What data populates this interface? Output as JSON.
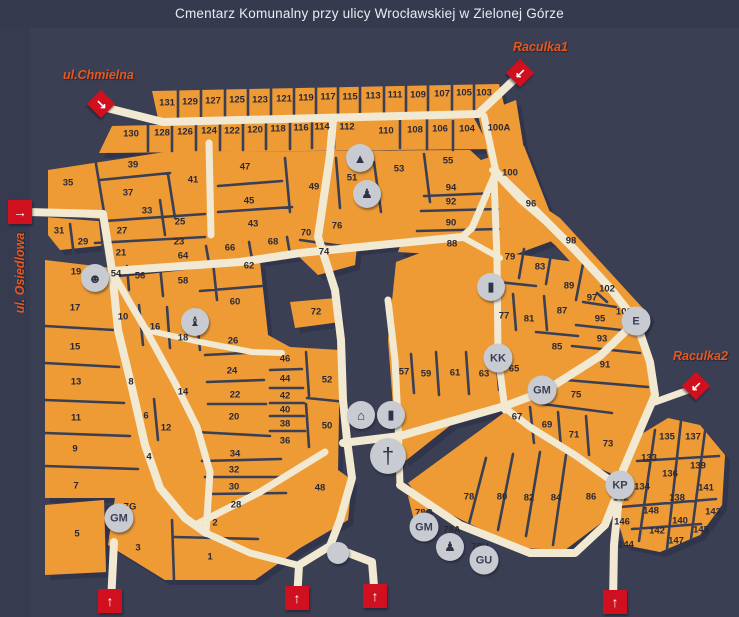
{
  "title": "Cmentarz Komunalny przy ulicy Wrocławskiej w Zielonej Górze",
  "streets": {
    "chmielna": "ul.Chmielna",
    "raculka1": "Raculka1",
    "raculka2": "Raculka2",
    "osiedlowa": "ul. Osiedlowa"
  },
  "colors": {
    "background": "#3b3f54",
    "block_orange": "#ef9b36",
    "path_cream": "#f2e9d2",
    "marker_red": "#d0101e",
    "street_label": "#e8571c",
    "badge_gray": "#c8cbd1",
    "title_text": "#e9ebf3",
    "number_text": "#2b2833"
  },
  "map": {
    "sections": [
      {
        "n": "131",
        "x": 167,
        "y": 103
      },
      {
        "n": "129",
        "x": 190,
        "y": 102
      },
      {
        "n": "127",
        "x": 213,
        "y": 101
      },
      {
        "n": "125",
        "x": 237,
        "y": 100
      },
      {
        "n": "123",
        "x": 260,
        "y": 100
      },
      {
        "n": "121",
        "x": 284,
        "y": 99
      },
      {
        "n": "119",
        "x": 306,
        "y": 98
      },
      {
        "n": "117",
        "x": 328,
        "y": 97
      },
      {
        "n": "115",
        "x": 350,
        "y": 97
      },
      {
        "n": "113",
        "x": 373,
        "y": 96
      },
      {
        "n": "111",
        "x": 395,
        "y": 95
      },
      {
        "n": "109",
        "x": 418,
        "y": 95
      },
      {
        "n": "107",
        "x": 442,
        "y": 94
      },
      {
        "n": "105",
        "x": 464,
        "y": 93
      },
      {
        "n": "103",
        "x": 484,
        "y": 93
      },
      {
        "n": "130",
        "x": 131,
        "y": 134
      },
      {
        "n": "128",
        "x": 162,
        "y": 133
      },
      {
        "n": "126",
        "x": 185,
        "y": 132
      },
      {
        "n": "124",
        "x": 209,
        "y": 131
      },
      {
        "n": "122",
        "x": 232,
        "y": 131
      },
      {
        "n": "120",
        "x": 255,
        "y": 130
      },
      {
        "n": "118",
        "x": 278,
        "y": 129
      },
      {
        "n": "116",
        "x": 301,
        "y": 128
      },
      {
        "n": "114",
        "x": 322,
        "y": 127
      },
      {
        "n": "112",
        "x": 347,
        "y": 127
      },
      {
        "n": "110",
        "x": 386,
        "y": 131
      },
      {
        "n": "108",
        "x": 415,
        "y": 130
      },
      {
        "n": "106",
        "x": 440,
        "y": 129
      },
      {
        "n": "104",
        "x": 467,
        "y": 129
      },
      {
        "n": "100A",
        "x": 499,
        "y": 128
      },
      {
        "n": "35",
        "x": 68,
        "y": 183
      },
      {
        "n": "39",
        "x": 133,
        "y": 165
      },
      {
        "n": "37",
        "x": 128,
        "y": 193
      },
      {
        "n": "41",
        "x": 193,
        "y": 180
      },
      {
        "n": "47",
        "x": 245,
        "y": 167
      },
      {
        "n": "45",
        "x": 249,
        "y": 201
      },
      {
        "n": "49",
        "x": 314,
        "y": 187
      },
      {
        "n": "51",
        "x": 352,
        "y": 178
      },
      {
        "n": "53",
        "x": 399,
        "y": 169
      },
      {
        "n": "55",
        "x": 448,
        "y": 161
      },
      {
        "n": "33",
        "x": 147,
        "y": 211
      },
      {
        "n": "25",
        "x": 180,
        "y": 222
      },
      {
        "n": "43",
        "x": 253,
        "y": 224
      },
      {
        "n": "31",
        "x": 59,
        "y": 231
      },
      {
        "n": "27",
        "x": 122,
        "y": 231
      },
      {
        "n": "29",
        "x": 83,
        "y": 242
      },
      {
        "n": "23",
        "x": 179,
        "y": 242
      },
      {
        "n": "21",
        "x": 121,
        "y": 253
      },
      {
        "n": "76",
        "x": 337,
        "y": 226
      },
      {
        "n": "70",
        "x": 306,
        "y": 233
      },
      {
        "n": "68",
        "x": 273,
        "y": 242
      },
      {
        "n": "66",
        "x": 230,
        "y": 248
      },
      {
        "n": "64",
        "x": 183,
        "y": 256
      },
      {
        "n": "74",
        "x": 324,
        "y": 252
      },
      {
        "n": "19",
        "x": 76,
        "y": 272
      },
      {
        "n": "54",
        "x": 116,
        "y": 274
      },
      {
        "n": "56",
        "x": 140,
        "y": 276
      },
      {
        "n": "58",
        "x": 183,
        "y": 281
      },
      {
        "n": "62",
        "x": 249,
        "y": 266
      },
      {
        "n": "60",
        "x": 235,
        "y": 302
      },
      {
        "n": "72",
        "x": 316,
        "y": 312
      },
      {
        "n": "17",
        "x": 75,
        "y": 308
      },
      {
        "n": "10",
        "x": 123,
        "y": 317
      },
      {
        "n": "16",
        "x": 155,
        "y": 327
      },
      {
        "n": "18",
        "x": 183,
        "y": 338
      },
      {
        "n": "15",
        "x": 75,
        "y": 347
      },
      {
        "n": "26",
        "x": 233,
        "y": 341
      },
      {
        "n": "13",
        "x": 76,
        "y": 382
      },
      {
        "n": "8",
        "x": 131,
        "y": 382
      },
      {
        "n": "14",
        "x": 183,
        "y": 392
      },
      {
        "n": "24",
        "x": 232,
        "y": 371
      },
      {
        "n": "22",
        "x": 235,
        "y": 395
      },
      {
        "n": "20",
        "x": 234,
        "y": 417
      },
      {
        "n": "11",
        "x": 76,
        "y": 418
      },
      {
        "n": "6",
        "x": 146,
        "y": 416
      },
      {
        "n": "12",
        "x": 166,
        "y": 428
      },
      {
        "n": "9",
        "x": 75,
        "y": 449
      },
      {
        "n": "4",
        "x": 149,
        "y": 457
      },
      {
        "n": "34",
        "x": 235,
        "y": 454
      },
      {
        "n": "32",
        "x": 234,
        "y": 470
      },
      {
        "n": "30",
        "x": 234,
        "y": 487
      },
      {
        "n": "28",
        "x": 236,
        "y": 505
      },
      {
        "n": "7",
        "x": 76,
        "y": 486
      },
      {
        "n": "5",
        "x": 77,
        "y": 534
      },
      {
        "n": "3",
        "x": 138,
        "y": 548
      },
      {
        "n": "1",
        "x": 210,
        "y": 557
      },
      {
        "n": "2",
        "x": 215,
        "y": 523
      },
      {
        "n": "7G",
        "x": 130,
        "y": 507
      },
      {
        "n": "46",
        "x": 285,
        "y": 359
      },
      {
        "n": "44",
        "x": 285,
        "y": 379
      },
      {
        "n": "42",
        "x": 285,
        "y": 396
      },
      {
        "n": "40",
        "x": 285,
        "y": 410
      },
      {
        "n": "38",
        "x": 285,
        "y": 424
      },
      {
        "n": "36",
        "x": 285,
        "y": 441
      },
      {
        "n": "52",
        "x": 327,
        "y": 380
      },
      {
        "n": "50",
        "x": 327,
        "y": 426
      },
      {
        "n": "48",
        "x": 320,
        "y": 488
      },
      {
        "n": "57",
        "x": 404,
        "y": 372
      },
      {
        "n": "59",
        "x": 426,
        "y": 374
      },
      {
        "n": "61",
        "x": 455,
        "y": 373
      },
      {
        "n": "63",
        "x": 484,
        "y": 374
      },
      {
        "n": "65",
        "x": 514,
        "y": 369
      },
      {
        "n": "67",
        "x": 517,
        "y": 417
      },
      {
        "n": "69",
        "x": 547,
        "y": 425
      },
      {
        "n": "71",
        "x": 574,
        "y": 435
      },
      {
        "n": "73",
        "x": 608,
        "y": 444
      },
      {
        "n": "75",
        "x": 576,
        "y": 395
      },
      {
        "n": "100",
        "x": 510,
        "y": 173
      },
      {
        "n": "94",
        "x": 451,
        "y": 188
      },
      {
        "n": "92",
        "x": 451,
        "y": 202
      },
      {
        "n": "96",
        "x": 531,
        "y": 204
      },
      {
        "n": "90",
        "x": 451,
        "y": 223
      },
      {
        "n": "88",
        "x": 452,
        "y": 244
      },
      {
        "n": "98",
        "x": 571,
        "y": 241
      },
      {
        "n": "79",
        "x": 510,
        "y": 257
      },
      {
        "n": "83",
        "x": 540,
        "y": 267
      },
      {
        "n": "89",
        "x": 569,
        "y": 286
      },
      {
        "n": "102",
        "x": 607,
        "y": 289
      },
      {
        "n": "97",
        "x": 592,
        "y": 298
      },
      {
        "n": "77",
        "x": 504,
        "y": 316
      },
      {
        "n": "81",
        "x": 529,
        "y": 319
      },
      {
        "n": "87",
        "x": 562,
        "y": 311
      },
      {
        "n": "95",
        "x": 600,
        "y": 319
      },
      {
        "n": "102E",
        "x": 627,
        "y": 312
      },
      {
        "n": "93",
        "x": 602,
        "y": 339
      },
      {
        "n": "85",
        "x": 557,
        "y": 347
      },
      {
        "n": "91",
        "x": 605,
        "y": 365
      },
      {
        "n": "78",
        "x": 469,
        "y": 497
      },
      {
        "n": "80",
        "x": 502,
        "y": 497
      },
      {
        "n": "82",
        "x": 529,
        "y": 498
      },
      {
        "n": "84",
        "x": 556,
        "y": 498
      },
      {
        "n": "86",
        "x": 591,
        "y": 497
      },
      {
        "n": "78G",
        "x": 424,
        "y": 513
      },
      {
        "n": "78A",
        "x": 452,
        "y": 530
      },
      {
        "n": "78U",
        "x": 480,
        "y": 547
      },
      {
        "n": "132",
        "x": 621,
        "y": 498
      },
      {
        "n": "133",
        "x": 649,
        "y": 458
      },
      {
        "n": "135",
        "x": 667,
        "y": 437
      },
      {
        "n": "137",
        "x": 693,
        "y": 437
      },
      {
        "n": "136",
        "x": 670,
        "y": 474
      },
      {
        "n": "139",
        "x": 698,
        "y": 466
      },
      {
        "n": "134",
        "x": 642,
        "y": 487
      },
      {
        "n": "141",
        "x": 706,
        "y": 488
      },
      {
        "n": "138",
        "x": 677,
        "y": 498
      },
      {
        "n": "148",
        "x": 651,
        "y": 511
      },
      {
        "n": "143",
        "x": 713,
        "y": 512
      },
      {
        "n": "146",
        "x": 622,
        "y": 522
      },
      {
        "n": "140",
        "x": 680,
        "y": 521
      },
      {
        "n": "142",
        "x": 657,
        "y": 531
      },
      {
        "n": "145",
        "x": 701,
        "y": 530
      },
      {
        "n": "144",
        "x": 626,
        "y": 545
      },
      {
        "n": "147",
        "x": 676,
        "y": 541
      }
    ],
    "badges": [
      {
        "t": "KK",
        "x": 498,
        "y": 358
      },
      {
        "t": "GM",
        "x": 542,
        "y": 390
      },
      {
        "t": "E",
        "x": 636,
        "y": 321
      },
      {
        "t": "KP",
        "x": 620,
        "y": 485
      },
      {
        "t": "GM",
        "x": 119,
        "y": 518
      },
      {
        "t": "GM",
        "x": 424,
        "y": 527
      },
      {
        "t": "GU",
        "x": 484,
        "y": 560
      }
    ],
    "symbols": [
      {
        "k": "obelisk-monument",
        "x": 360,
        "y": 158
      },
      {
        "k": "statue",
        "x": 367,
        "y": 194
      },
      {
        "k": "bust-monument",
        "x": 95,
        "y": 278
      },
      {
        "k": "angel-statue",
        "x": 195,
        "y": 322
      },
      {
        "k": "tomb-monument",
        "x": 491,
        "y": 287
      },
      {
        "k": "chapel",
        "x": 361,
        "y": 415
      },
      {
        "k": "candle",
        "x": 391,
        "y": 415
      },
      {
        "k": "cross",
        "x": 388,
        "y": 456
      },
      {
        "k": "statue",
        "x": 450,
        "y": 547
      },
      {
        "k": "dot",
        "x": 338,
        "y": 553
      }
    ],
    "glyphs": {
      "obelisk-monument": "▲",
      "statue": "♟",
      "bust-monument": "☻",
      "angel-statue": "♝",
      "tomb-monument": "▮",
      "chapel": "⌂",
      "candle": "▮",
      "cross": "†",
      "dot": ""
    },
    "entrances": [
      {
        "id": "chmielna",
        "shape": "diamond",
        "x": 101,
        "y": 104,
        "arrow": "↘"
      },
      {
        "id": "raculka1",
        "shape": "diamond",
        "x": 520,
        "y": 73,
        "arrow": "↙"
      },
      {
        "id": "raculka2",
        "shape": "diamond",
        "x": 696,
        "y": 386,
        "arrow": "↙"
      },
      {
        "id": "osiedlowa",
        "shape": "square",
        "x": 20,
        "y": 212,
        "arrow": "→"
      },
      {
        "id": "south-1",
        "shape": "square",
        "x": 110,
        "y": 601,
        "arrow": "↑"
      },
      {
        "id": "south-2",
        "shape": "square",
        "x": 297,
        "y": 598,
        "arrow": "↑"
      },
      {
        "id": "south-3",
        "shape": "square",
        "x": 375,
        "y": 596,
        "arrow": "↑"
      },
      {
        "id": "south-4",
        "shape": "square",
        "x": 615,
        "y": 602,
        "arrow": "↑"
      }
    ]
  }
}
